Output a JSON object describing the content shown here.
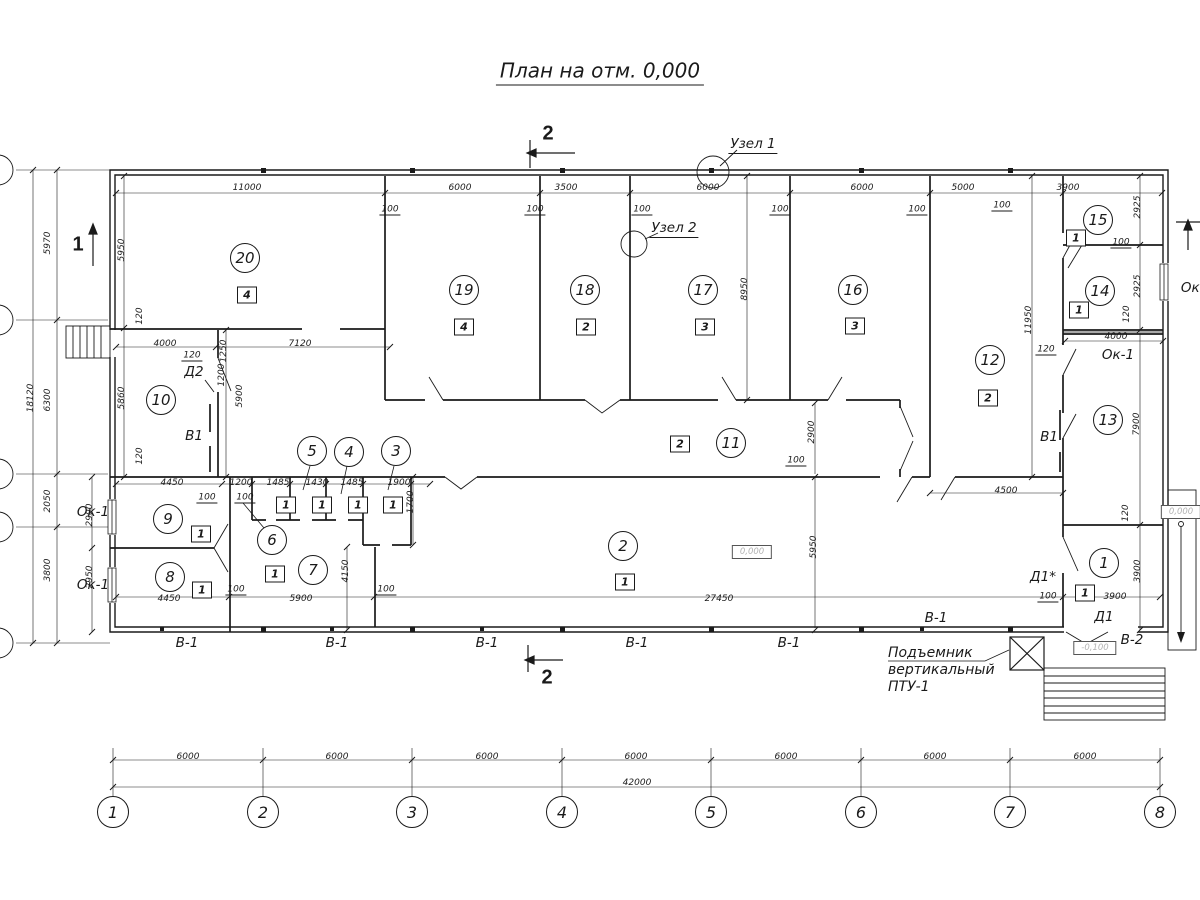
{
  "title": "План на отм. 0,000",
  "lift_note": {
    "line1": "Подъемник",
    "line2": "вертикальный",
    "line3": "ПТУ-1"
  },
  "drawing": {
    "line_color": "#1a1a1a",
    "sections": [
      {
        "t": "2",
        "x": 548,
        "y": 134
      },
      {
        "t": "2",
        "x": 547,
        "y": 678
      },
      {
        "t": "1",
        "x": 78,
        "y": 245
      }
    ],
    "room_circles": [
      {
        "t": "20",
        "x": 245,
        "y": 258
      },
      {
        "t": "19",
        "x": 464,
        "y": 290
      },
      {
        "t": "18",
        "x": 585,
        "y": 290
      },
      {
        "t": "17",
        "x": 703,
        "y": 290
      },
      {
        "t": "16",
        "x": 853,
        "y": 290
      },
      {
        "t": "15",
        "x": 1098,
        "y": 220
      },
      {
        "t": "14",
        "x": 1100,
        "y": 291
      },
      {
        "t": "12",
        "x": 990,
        "y": 360
      },
      {
        "t": "13",
        "x": 1108,
        "y": 420
      },
      {
        "t": "11",
        "x": 731,
        "y": 443
      },
      {
        "t": "10",
        "x": 161,
        "y": 400
      },
      {
        "t": "9",
        "x": 168,
        "y": 519
      },
      {
        "t": "8",
        "x": 170,
        "y": 577
      },
      {
        "t": "6",
        "x": 272,
        "y": 540
      },
      {
        "t": "7",
        "x": 313,
        "y": 570
      },
      {
        "t": "5",
        "x": 312,
        "y": 451
      },
      {
        "t": "4",
        "x": 349,
        "y": 452
      },
      {
        "t": "3",
        "x": 396,
        "y": 451
      },
      {
        "t": "2",
        "x": 623,
        "y": 546
      },
      {
        "t": "1",
        "x": 1104,
        "y": 563
      }
    ],
    "tags": [
      {
        "t": "4",
        "x": 247,
        "y": 295
      },
      {
        "t": "4",
        "x": 464,
        "y": 327
      },
      {
        "t": "2",
        "x": 586,
        "y": 327
      },
      {
        "t": "3",
        "x": 705,
        "y": 327
      },
      {
        "t": "3",
        "x": 855,
        "y": 326
      },
      {
        "t": "1",
        "x": 1076,
        "y": 238
      },
      {
        "t": "1",
        "x": 1079,
        "y": 310
      },
      {
        "t": "2",
        "x": 988,
        "y": 398
      },
      {
        "t": "2",
        "x": 680,
        "y": 444
      },
      {
        "t": "1",
        "x": 201,
        "y": 534
      },
      {
        "t": "1",
        "x": 202,
        "y": 590
      },
      {
        "t": "1",
        "x": 286,
        "y": 505
      },
      {
        "t": "1",
        "x": 322,
        "y": 505
      },
      {
        "t": "1",
        "x": 358,
        "y": 505
      },
      {
        "t": "1",
        "x": 393,
        "y": 505
      },
      {
        "t": "1",
        "x": 275,
        "y": 574
      },
      {
        "t": "1",
        "x": 625,
        "y": 582
      },
      {
        "t": "1",
        "x": 1085,
        "y": 593
      }
    ],
    "dims": [
      {
        "t": "11000",
        "x": 247,
        "y": 188
      },
      {
        "t": "6000",
        "x": 460,
        "y": 188
      },
      {
        "t": "3500",
        "x": 566,
        "y": 188
      },
      {
        "t": "6000",
        "x": 708,
        "y": 188
      },
      {
        "t": "6000",
        "x": 862,
        "y": 188
      },
      {
        "t": "5000",
        "x": 963,
        "y": 188
      },
      {
        "t": "3900",
        "x": 1068,
        "y": 188
      },
      {
        "t": "100",
        "x": 390,
        "y": 210,
        "u": 1
      },
      {
        "t": "100",
        "x": 535,
        "y": 210,
        "u": 1
      },
      {
        "t": "100",
        "x": 642,
        "y": 210,
        "u": 1
      },
      {
        "t": "100",
        "x": 780,
        "y": 210,
        "u": 1
      },
      {
        "t": "100",
        "x": 917,
        "y": 210,
        "u": 1
      },
      {
        "t": "100",
        "x": 1002,
        "y": 206,
        "u": 1
      },
      {
        "t": "100",
        "x": 1121,
        "y": 243,
        "u": 1
      },
      {
        "t": "5970",
        "x": 48,
        "y": 243,
        "r": 1
      },
      {
        "t": "6300",
        "x": 48,
        "y": 400,
        "r": 1
      },
      {
        "t": "2050",
        "x": 48,
        "y": 501,
        "r": 1
      },
      {
        "t": "3800",
        "x": 48,
        "y": 570,
        "r": 1
      },
      {
        "t": "18120",
        "x": 31,
        "y": 398,
        "r": 1
      },
      {
        "t": "5950",
        "x": 122,
        "y": 250,
        "r": 1
      },
      {
        "t": "5860",
        "x": 122,
        "y": 398,
        "r": 1
      },
      {
        "t": "120",
        "x": 140,
        "y": 316,
        "r": 1
      },
      {
        "t": "120",
        "x": 140,
        "y": 456,
        "r": 1
      },
      {
        "t": "4000",
        "x": 165,
        "y": 344
      },
      {
        "t": "7120",
        "x": 300,
        "y": 344
      },
      {
        "t": "120",
        "x": 192,
        "y": 356,
        "u": 1
      },
      {
        "t": "1250",
        "x": 224,
        "y": 351,
        "r": 1
      },
      {
        "t": "1200",
        "x": 222,
        "y": 375,
        "r": 1
      },
      {
        "t": "5900",
        "x": 240,
        "y": 396,
        "r": 1
      },
      {
        "t": "4450",
        "x": 172,
        "y": 483
      },
      {
        "t": "1200",
        "x": 241,
        "y": 483
      },
      {
        "t": "1485",
        "x": 278,
        "y": 483
      },
      {
        "t": "1430",
        "x": 317,
        "y": 483
      },
      {
        "t": "1485",
        "x": 352,
        "y": 483
      },
      {
        "t": "1900",
        "x": 399,
        "y": 483
      },
      {
        "t": "100",
        "x": 207,
        "y": 498,
        "u": 1
      },
      {
        "t": "100",
        "x": 245,
        "y": 498,
        "u": 1
      },
      {
        "t": "1700",
        "x": 411,
        "y": 502,
        "r": 1
      },
      {
        "t": "2900",
        "x": 90,
        "y": 515,
        "r": 1
      },
      {
        "t": "2950",
        "x": 90,
        "y": 577,
        "r": 1
      },
      {
        "t": "4150",
        "x": 346,
        "y": 571,
        "r": 1
      },
      {
        "t": "4450",
        "x": 169,
        "y": 599
      },
      {
        "t": "5900",
        "x": 301,
        "y": 599
      },
      {
        "t": "27450",
        "x": 719,
        "y": 599
      },
      {
        "t": "100",
        "x": 236,
        "y": 590,
        "u": 1
      },
      {
        "t": "100",
        "x": 386,
        "y": 590,
        "u": 1
      },
      {
        "t": "2900",
        "x": 812,
        "y": 432,
        "r": 1
      },
      {
        "t": "100",
        "x": 796,
        "y": 461,
        "u": 1
      },
      {
        "t": "5950",
        "x": 814,
        "y": 547,
        "r": 1
      },
      {
        "t": "8950",
        "x": 745,
        "y": 289,
        "r": 1
      },
      {
        "t": "11950",
        "x": 1029,
        "y": 320,
        "r": 1
      },
      {
        "t": "2925",
        "x": 1138,
        "y": 207,
        "r": 1
      },
      {
        "t": "2925",
        "x": 1138,
        "y": 286,
        "r": 1
      },
      {
        "t": "120",
        "x": 1127,
        "y": 314,
        "r": 1
      },
      {
        "t": "4000",
        "x": 1116,
        "y": 337
      },
      {
        "t": "120",
        "x": 1046,
        "y": 350,
        "u": 1
      },
      {
        "t": "7900",
        "x": 1137,
        "y": 424,
        "r": 1
      },
      {
        "t": "4500",
        "x": 1006,
        "y": 491
      },
      {
        "t": "120",
        "x": 1126,
        "y": 513,
        "r": 1
      },
      {
        "t": "3900",
        "x": 1138,
        "y": 571,
        "r": 1
      },
      {
        "t": "100",
        "x": 1048,
        "y": 597,
        "u": 1
      },
      {
        "t": "3900",
        "x": 1115,
        "y": 597
      },
      {
        "t": "6000",
        "x": 188,
        "y": 757
      },
      {
        "t": "6000",
        "x": 337,
        "y": 757
      },
      {
        "t": "6000",
        "x": 487,
        "y": 757
      },
      {
        "t": "6000",
        "x": 636,
        "y": 757
      },
      {
        "t": "6000",
        "x": 786,
        "y": 757
      },
      {
        "t": "6000",
        "x": 935,
        "y": 757
      },
      {
        "t": "6000",
        "x": 1085,
        "y": 757
      },
      {
        "t": "42000",
        "x": 637,
        "y": 783
      }
    ],
    "texts": [
      {
        "n": "node-callout-1",
        "t": "Узел 1",
        "x": 753,
        "y": 145,
        "u": 1
      },
      {
        "n": "node-callout-2",
        "t": "Узел 2",
        "x": 674,
        "y": 229,
        "u": 1
      },
      {
        "n": "door-label-d2",
        "t": "Д2",
        "x": 194,
        "y": 372
      },
      {
        "n": "vent-label-v1-left",
        "t": "В1",
        "x": 194,
        "y": 436
      },
      {
        "n": "vent-label-v1-right",
        "t": "В1",
        "x": 1049,
        "y": 437
      },
      {
        "n": "door-label-d1-star",
        "t": "Д1*",
        "x": 1043,
        "y": 577
      },
      {
        "n": "door-label-d1",
        "t": "Д1",
        "x": 1104,
        "y": 617
      },
      {
        "n": "panel-label-v2",
        "t": "В-2",
        "x": 1132,
        "y": 640
      },
      {
        "n": "panel-label-v1",
        "t": "В-1",
        "x": 187,
        "y": 643
      },
      {
        "n": "panel-label-v1",
        "t": "В-1",
        "x": 337,
        "y": 643
      },
      {
        "n": "panel-label-v1",
        "t": "В-1",
        "x": 487,
        "y": 643
      },
      {
        "n": "panel-label-v1",
        "t": "В-1",
        "x": 637,
        "y": 643
      },
      {
        "n": "panel-label-v1",
        "t": "В-1",
        "x": 789,
        "y": 643
      },
      {
        "n": "panel-label-v1",
        "t": "В-1",
        "x": 936,
        "y": 618
      },
      {
        "n": "window-label-ok1",
        "t": "Ок-1",
        "x": 93,
        "y": 512
      },
      {
        "n": "window-label-ok1",
        "t": "Ок-1",
        "x": 93,
        "y": 585
      },
      {
        "n": "window-label-ok1",
        "t": "Ок-1",
        "x": 1118,
        "y": 355
      },
      {
        "n": "window-label-ok1",
        "t": "Ок-1",
        "x": 1197,
        "y": 288
      }
    ],
    "elevations": [
      {
        "t": "0,000",
        "x": 752,
        "y": 552
      },
      {
        "t": "0,000",
        "x": 1181,
        "y": 512
      },
      {
        "t": "-0,100",
        "x": 1095,
        "y": 648
      }
    ],
    "axes_bottom": {
      "y": 812,
      "labels": [
        "1",
        "2",
        "3",
        "4",
        "5",
        "6",
        "7",
        "8"
      ],
      "xs": [
        113,
        263,
        412,
        562,
        711,
        861,
        1010,
        1160
      ]
    }
  }
}
